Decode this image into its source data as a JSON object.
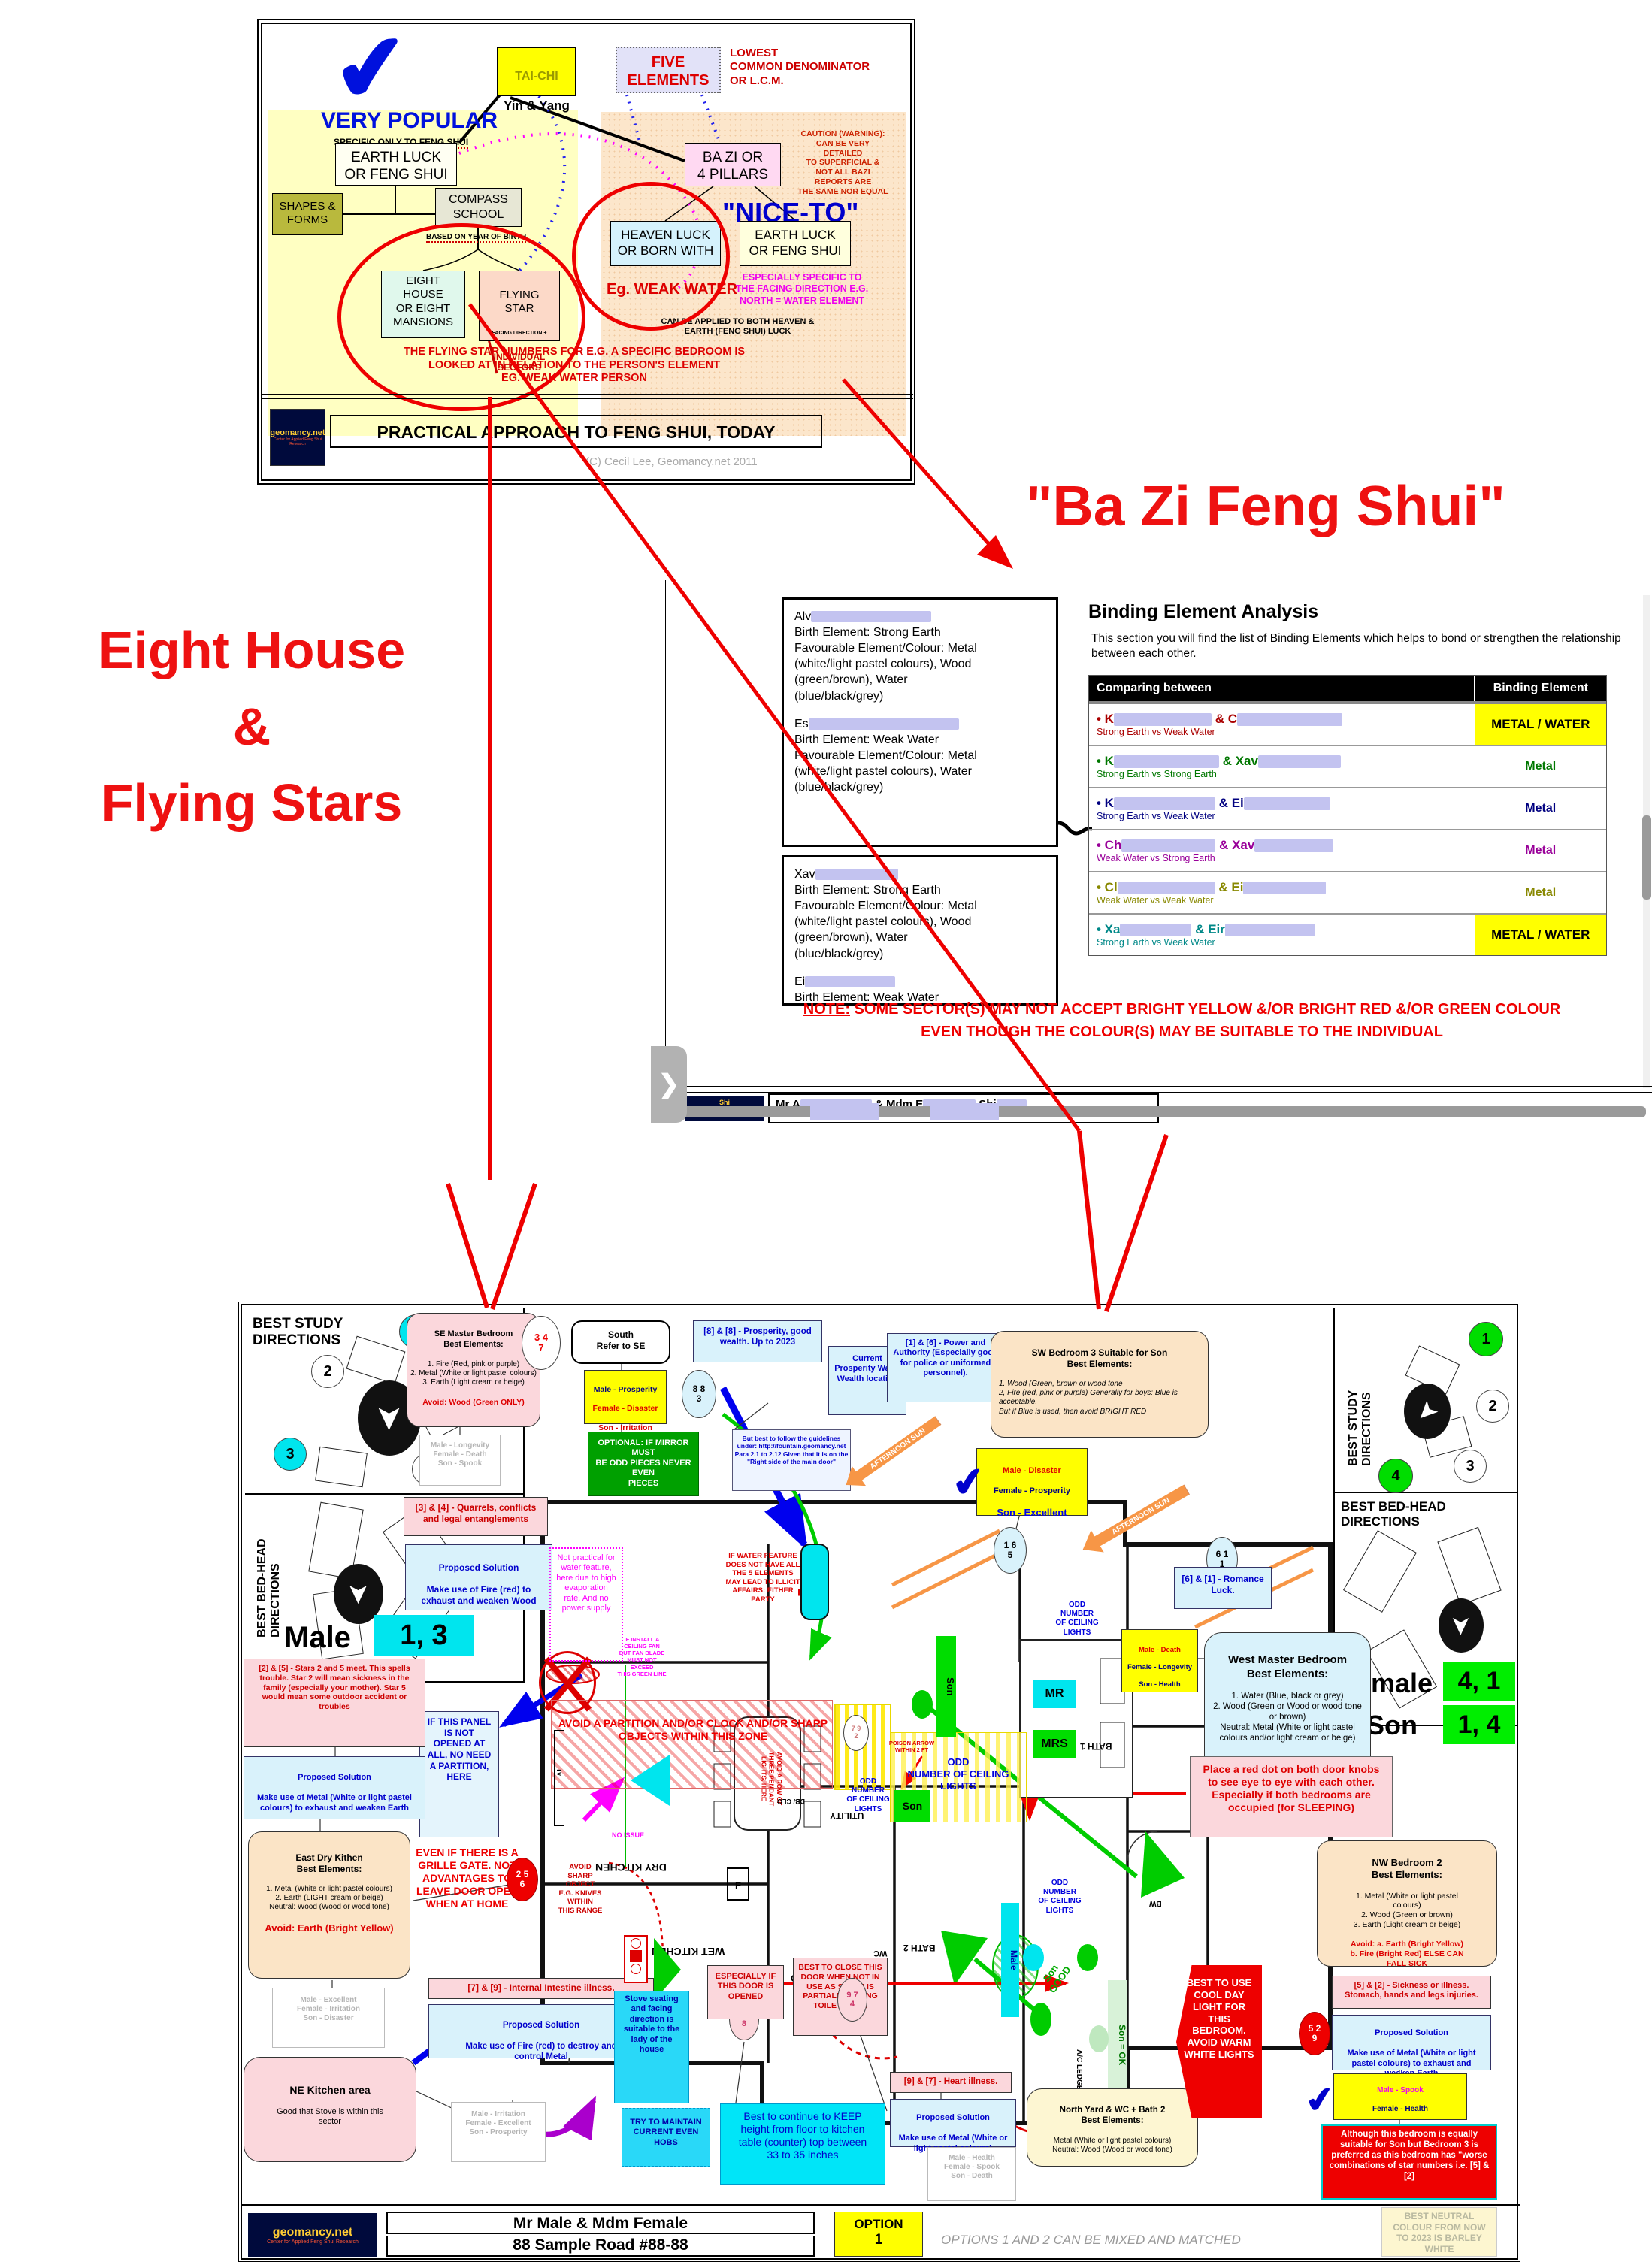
{
  "icons": {
    "check": "✔",
    "chevron": "❯",
    "compass_arrow": "➤",
    "pool": "≈"
  },
  "diagram": {
    "very_popular": "VERY POPULAR",
    "specific_only": "SPECIFIC ONLY TO ",
    "specific_only_em": "FENG SHUI",
    "tai_chi_1": "TAI-CHI",
    "tai_chi_2": "Yin & Yang",
    "five_elements": "FIVE\nELEMENTS",
    "lcd": "LOWEST\nCOMMON DENOMINATOR\nOR L.C.M.",
    "earth_luck_left": "EARTH LUCK\nOR FENG SHUI",
    "caution": "CAUTION (WARNING):\nCAN BE VERY\nDETAILED\nTO SUPERFICIAL &\nNOT ALL BAZI\nREPORTS ARE\nTHE SAME NOR EQUAL",
    "shapes": "SHAPES &\nFORMS",
    "compass": "COMPASS\nSCHOOL",
    "based_on": "BASED ON",
    "year_of_birth": "YEAR OF BIRTH",
    "ba_zi": "BA ZI OR\n4 PILLARS",
    "nice_to": "\"NICE-TO\"",
    "heaven_luck": "HEAVEN LUCK\nOR BORN WITH",
    "earth_luck_right": "EARTH LUCK\nOR FENG SHUI",
    "eg_weak_water": "Eg. WEAK WATER",
    "especially": "ESPECIALLY SPECIFIC TO\nTHE FACING DIRECTION E.G.\nNORTH = WATER ELEMENT",
    "eight_house": "EIGHT\nHOUSE\nOR EIGHT\nMANSIONS",
    "flying_star_1": "FLYING\nSTAR",
    "flying_star_2": "FACING DIRECTION +",
    "flying_star_3": "INDIVIDUAL\nSECTORS",
    "can_be_applied": "CAN BE APPLIED TO BOTH HEAVEN &\nEARTH (FENG SHUI) LUCK",
    "flying_note": "THE FLYING STAR NUMBERS FOR E.G. A SPECIFIC BEDROOM IS\nLOOKED AT IN RELATION TO THE PERSON'S ELEMENT\nEG.  WEAK WATER PERSON",
    "footer_title": "PRACTICAL APPROACH TO FENG SHUI, TODAY",
    "copyright": "(C) Cecil Lee, Geomancy.net 2011",
    "logo_main": "geomancy.net",
    "logo_sub": "Center for Applied Feng Shui Research"
  },
  "bazi_heading": "\"Ba Zi Feng Shui\"",
  "left_heading": {
    "l1": "Eight House",
    "l2": "&",
    "l3": "Flying Stars"
  },
  "panel": {
    "p1a_prefix": "Alv",
    "p1a": "Birth Element: Strong Earth\nFavourable Element/Colour: Metal\n(white/light pastel colours), Wood\n(green/brown), Water\n(blue/black/grey)",
    "p1b_prefix": "Es",
    "p1b": "Birth Element: Weak Water\nFavourable Element/Colour: Metal\n(white/light pastel colours), Water\n(blue/black/grey)",
    "p2a_prefix": "Xav",
    "p2a": "Birth Element: Strong Earth\nFavourable Element/Colour: Metal\n(white/light pastel colours), Wood\n(green/brown), Water\n(blue/black/grey)",
    "p2b_prefix": "Ei",
    "p2b": "Birth Element: Weak Water\nFavourable Element/Colour: Metal\n(white/light pastel colours), Water\n(blue/black/grey)",
    "heading": "Binding Element Analysis",
    "intro": "This section you will find the list of Binding Elements which helps to bond or strengthen the relationship between each other.",
    "col1": "Comparing between",
    "col2": "Binding Element",
    "rows": [
      {
        "a": "• K",
        "b": "& C",
        "sub": "Strong Earth vs Weak Water",
        "val": "METAL / WATER"
      },
      {
        "a": "• K",
        "b": "& Xav",
        "sub": "Strong Earth vs Strong Earth",
        "val": "Metal"
      },
      {
        "a": "• K",
        "b": "& Ei",
        "sub": "Strong Earth vs Weak Water",
        "val": "Metal"
      },
      {
        "a": "• Ch",
        "b": "& Xav",
        "sub": "Weak Water vs Strong Earth",
        "val": "Metal"
      },
      {
        "a": "• Cl",
        "b": "& Ei",
        "sub": "Weak Water vs Weak Water",
        "val": "Metal"
      },
      {
        "a": "• Xa",
        "b": "& Eir",
        "sub": "Strong Earth vs Weak Water",
        "val": "METAL / WATER"
      }
    ],
    "note_label": "NOTE:",
    "note1": " SOME SECTOR(S) MAY NOT ACCEPT BRIGHT YELLOW &/OR BRIGHT RED &/OR GREEN COLOUR",
    "note2": "EVEN THOUGH THE COLOUR(S) MAY BE SUITABLE TO THE INDIVIDUAL",
    "partial_1": "Mr A",
    "partial_2": "& Mdm E",
    "partial_3": "Shi"
  },
  "plan": {
    "sidebar_title": "BEST STUDY\nDIRECTIONS",
    "bedhead_title": "BEST BED-HEAD\nDIRECTIONS",
    "nums": [
      "1",
      "2",
      "3",
      "4"
    ],
    "male_label": "Male",
    "male_vals": "1, 3",
    "female_label": "Female",
    "female_vals": "4, 1",
    "son_label": "Son",
    "son_vals": "1, 4",
    "se_title": "SE Master Bedroom\nBest Elements:",
    "se_body": "1. Fire (Red, pink or purple)\n2. Metal (White or light pastel colours)\n3. Earth (Light cream or beige)",
    "se_avoid": "Avoid: Wood (Green ONLY)",
    "c347": "3 4\n7",
    "c883": "8 8\n3",
    "c165": "1 6\n5",
    "c611": "6 1\n1",
    "c256": "2 5\n6",
    "c438": "4 3\n8",
    "c974": "9 7\n4",
    "c529": "5 2\n9",
    "c792": "7 9\n2",
    "grey1": "Male -  Longevity\nFemale -  Death\nSon -  Spook",
    "q34": "[3] & [4] - Quarrels, conflicts\nand legal entanglements",
    "sol_title": "Proposed Solution",
    "sol_wood": "Make use of Fire (red) to\nexhaust and weaken Wood",
    "south": "South\nRefer to SE",
    "y1_male": "Male -  Prosperity",
    "y1_female": "Female -  Disaster",
    "y1_son": "Son -  Irritation",
    "mirror": "OPTIONAL: IF MIRROR MUST\nBE ODD PIECES NEVER EVEN\nPIECES",
    "p88": "[8] & [8] - Prosperity, good\nwealth. Up to 2023",
    "wealth": "Current\nProsperity Water\nWealth location",
    "guidelines": "But best to follow the guidelines\nunder: http://fountain.geomancy.net\nPara 2.1 to 2.12 Given that it is on the\n\"Right side of the main door\"",
    "power16": "[1] & [6] - Power and\nAuthority (Especially good\nfor police or uniformed\npersonnel).",
    "sw_title": "SW  Bedroom 3 Suitable for Son\nBest Elements:",
    "sw_body": "1.  Wood (Green, brown or wood tone\n2, Fire (red, pink or purple) Generally for boys: Blue is acceptable.\nBut if Blue is used, then avoid BRIGHT RED",
    "y2_male": "Male -  Disaster",
    "y2_female": "Female -  Prosperity",
    "y2_son": "Son - Excellent",
    "romance": "[6] & [1] - Romance\nLuck.",
    "west_title": "West Master Bedroom\nBest Elements:",
    "west_body": "1. Water (Blue, black or grey)\n2. Wood (Green or Wood or wood tone\nor brown)\nNeutral: Metal (White or light pastel\ncolours and/or light cream or beige)",
    "y3_male": "Male -  Death",
    "y3_female": "Female -  Longevity",
    "y3_son": "Son -  Health",
    "afternoon_sun": "AFTERNOON SUN",
    "water_warn": "IF WATER FEATURE\nDOES NOT HAVE ALL\nTHE 5 ELEMENTS\nMAY LEAD TO ILLICIT\nAFFAIRS: EITHER\nPARTY",
    "not_practical": "Not practical for\nwater feature,\nhere due to high\nevaporation\nrate. And no\npower supply",
    "panel_note": "IF THIS PANEL\nIS NOT\nOPENED AT\nALL, NO NEED\nA PARTITION,\nHERE",
    "pendant": "AVOID A ROW OF\nTHREE PENDANT\nLIGHTS, HERE",
    "odd_sm": "ODD\nNUMBER\nOF CEILING\nLIGHTS",
    "odd_wide": "ODD\nNUMBER OF CEILING LIGHTS",
    "partition": "AVOID A PARTITION AND/OR CLOCK AND/OR SHARP\nOBJECTS WITHIN THIS ZONE",
    "fan": "IF INSTALL A\nCEILING FAN\nBUT FAN BLADE\nMUST NOT EXCEED\nTHIS GREEN  LINE",
    "stars25": "[2] & [5] - Stars 2 and 5 meet. This spells\ntrouble. Star 2 will mean sickness in the\nfamily (especially your mother). Star 5\nwould mean some outdoor accident or\ntroubles",
    "sol_metal": "Make use of Metal (White or light pastel\ncolours) to exhaust and weaken Earth",
    "east_title": "East Dry Kithen\nBest Elements:",
    "east_body": "1. Metal (White or light pastel colours)\n2. Earth (LIGHT cream or beige)\nNeutral: Wood (Wood or wood tone)",
    "east_avoid": "Avoid: Earth (Bright Yellow)",
    "grey2": "Male -  Excellent\nFemale -  Irritation\nSon -  Disaster",
    "avoid_sharp": "AVOID\nSHARP\nOBJECT\nE.G. KNIVES\nWITHIN\nTHIS RANGE",
    "grille": "EVEN IF THERE IS A\nGRILLE GATE. NOT\nADVANTAGES TO\nLEAVE DOOR OPEN\nWHEN AT HOME",
    "ne_title": "NE Kitchen area",
    "ne_body": "Good that Stove is within this\nsector",
    "ii79": "[7] & [9] - Internal Intestine illness.",
    "sol_fire": "Make use of Fire (red) to destroy and\ncontrol Metal",
    "grey3": "Male -  Irritation\nFemale -  Excellent\nSon -  Prosperity",
    "stove_seating": "Stove seating\nand facing\ndirection is\nsuitable to the\nlady of the\nhouse",
    "even_hobs": "TRY TO MAINTAIN\nCURRENT EVEN\nHOBS",
    "keep_height": "Best to continue to KEEP\nheight from floor to kitchen\ntable (counter) top between\n33 to 35 inches",
    "door_opened": "ESPECIALLY IF\nTHIS DOOR IS\nOPENED",
    "close_door": "BEST TO CLOSE THIS\nDOOR WHEN NOT IN\nUSE AS STOVE IS\nPARTIALLY FACING\nTOILET DOOR",
    "heart97": "[9] & [7] - Heart illness.",
    "sol_metal2": "Make use of Metal (White or\nlight pastel colours)",
    "north_title": "North Yard & WC + Bath 2\nBest Elements:",
    "north_body": "Metal (White or light pastel colours)\nNeutral: Wood (Wood or wood tone)",
    "grey4": "Male -  Health\nFemale -  Spook\nSon -  Death",
    "red_dot": "Place a red dot on both door knobs\nto see eye to eye with each other.\nEspecially if both bedrooms are\noccupied (for SLEEPING)",
    "nw_title": "NW Bedroom 2\nBest Elements:",
    "nw_body": "1. Metal (White or light pastel\ncolours)\n2. Wood (Green or brown)\n3. Earth (Light cream or beige)",
    "nw_avoid": "Avoid: a. Earth (Bright Yellow)\nb. Fire (Bright Red)  ELSE CAN\nFALL SICK",
    "sick52": "[5] & [2] - Sickness or illness.\nStomach, hands and legs injuries.",
    "sol_metal3": "Make use of Metal (White or light\npastel colours) to exhaust and\nweaken Earth",
    "y4_male": "Male -  Spook",
    "y4_female": "Female -  Health",
    "y4_son": "Son -  Longevity",
    "although": "Although this bedroom is equally\nsuitable for Son but Bedroom 3 is\npreferred as this bedroom has \"worse\ncombinations of star numbers i.e. [5] &\n[2]",
    "cool_light": "BEST TO USE\nCOOL DAY\nLIGHT FOR\nTHIS\nBEDROOM.\nAVOID WARM\nWHITE LIGHTS",
    "mr": "MR",
    "mrs": "MRS",
    "son_tag": "Son",
    "son_good": "Son\nGOOD",
    "son_ok": "Son = OK",
    "male_tag": "Male",
    "poison": "POISON ARROW\nWITHIN 2 FT",
    "no_issue": "NO ISSUE",
    "rooms": {
      "dry": "DRY KITCHEN",
      "wet": "WET KITCHEN",
      "yard": "YARD",
      "utility": "UTILITY",
      "bath1": "BATH 1",
      "bath2": "BATH 2",
      "wc": "WC",
      "ac": "A/C LEDGE",
      "db": "DB/ CLO",
      "f": "F",
      "tv": "TV",
      "bw": "BW"
    },
    "footer": {
      "name": "Mr Male & Mdm Female",
      "address": "88 Sample Road #88-88",
      "option_label": "OPTION",
      "option_num": "1",
      "mixed": "OPTIONS 1 AND 2 CAN BE MIXED AND MATCHED",
      "barley": "BEST NEUTRAL\nCOLOUR FROM NOW\nTO 2023 IS BARLEY\nWHITE",
      "logo_main": "geomancy.net",
      "logo_sub": "Center for Applied Feng Shui Research"
    }
  }
}
